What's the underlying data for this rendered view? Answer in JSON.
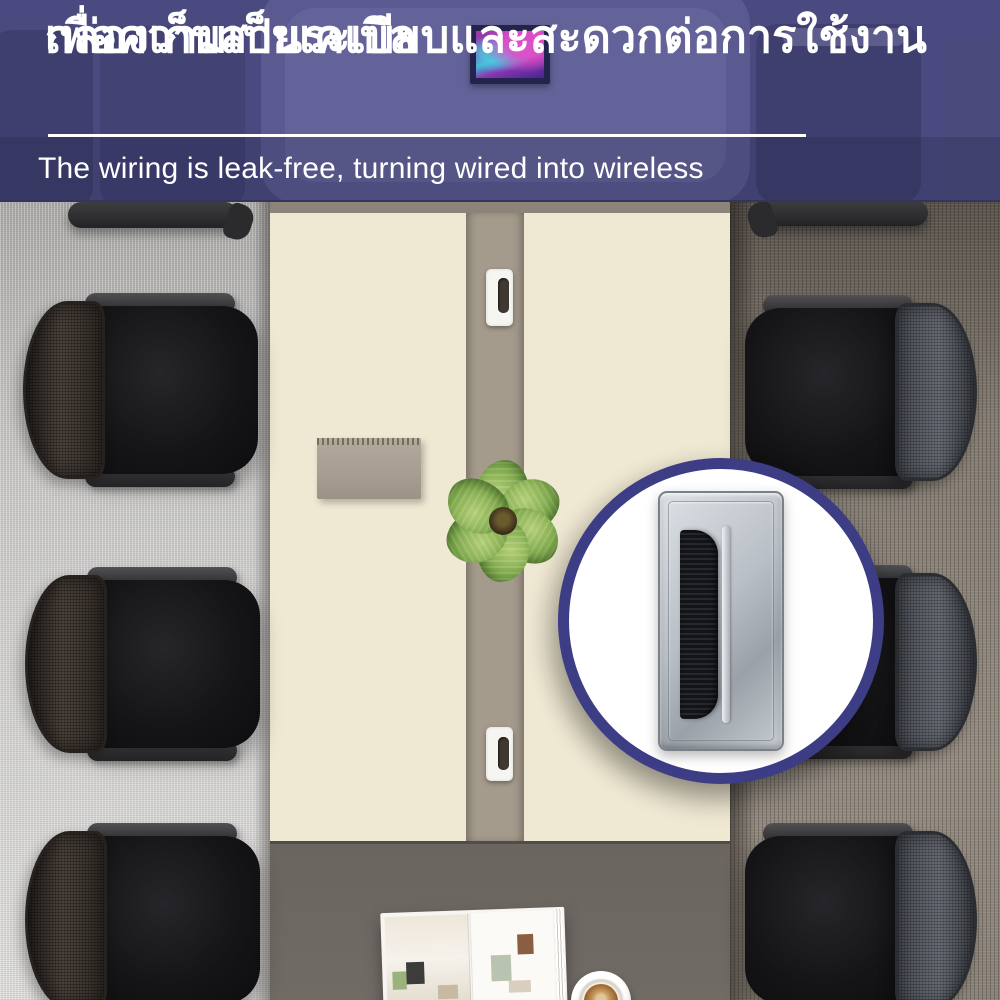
{
  "banner": {
    "title_line1": "กล่องเก็บสายเคเบิล",
    "title_line2": "เพื่อความเป็นระเบียบและสะดวกต่อการใช้งาน",
    "subtitle": "The wiring is leak-free, turning wired into wireless"
  },
  "inset": {
    "content": "cable-grommet-with-brush-product-closeup"
  },
  "scene": {
    "objects": [
      "conference-table",
      "office-chairs",
      "cable-grommets",
      "spiral-notebook",
      "potted-plant",
      "open-magazine",
      "coffee-cup",
      "framed-picture"
    ],
    "visible_chairs": 8
  },
  "theme": {
    "banner-overlay": "#4a4a80",
    "banner-strip-shade": "rgba(16,16,44,0.17)",
    "banner-text": "#ffffff",
    "divider": "#ffffff",
    "frame-navy": "#23234e",
    "inset-border": "#3d3d86",
    "table-cream": "#efe8d2",
    "table-strip": "#a59b8d",
    "table-dark": "#6b6560",
    "table-edge": "#8c8379",
    "carpet-left": "#c7c6c4",
    "carpet-right": "#8a8177",
    "chair-seat": "#141416",
    "grommet": "#f6f5f2",
    "leaf": "#7fa94c",
    "notebook": "#a89e92",
    "product-silver": "#b9bfc6",
    "brush": "#131417"
  }
}
